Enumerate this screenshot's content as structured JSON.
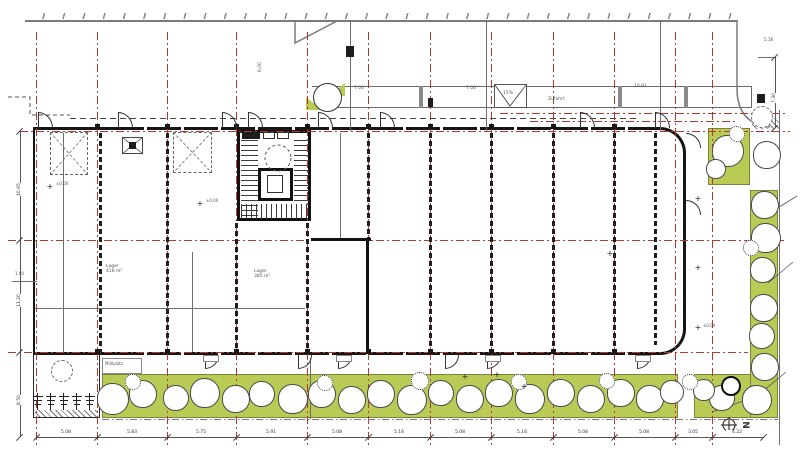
{
  "plan": {
    "north_label": "N",
    "colors": {
      "grid_red": "#b23a30",
      "landscape_green": "#b9ca55",
      "wall_dark": "#161616",
      "line_gray": "#6f6f6f"
    },
    "red_v": [
      36,
      97,
      167,
      236,
      307,
      368,
      430,
      491,
      553,
      614,
      675,
      712
    ],
    "red_h": [
      {
        "y": 131,
        "x1": 20,
        "x2": 790
      },
      {
        "y": 240,
        "x1": 8,
        "x2": 786
      },
      {
        "y": 352,
        "x1": 8,
        "x2": 748
      },
      {
        "y": 113,
        "x1": 500,
        "x2": 786
      },
      {
        "y": 121,
        "x1": 530,
        "x2": 737
      }
    ],
    "partitions": [
      {
        "x": 100,
        "y1": 133,
        "y2": 352
      },
      {
        "x": 167,
        "y1": 133,
        "y2": 352
      },
      {
        "x": 236,
        "y1": 223,
        "y2": 352
      },
      {
        "x": 307,
        "y1": 223,
        "y2": 352
      },
      {
        "x": 368,
        "y1": 133,
        "y2": 238
      },
      {
        "x": 430,
        "y1": 133,
        "y2": 352
      },
      {
        "x": 491,
        "y1": 133,
        "y2": 352
      },
      {
        "x": 553,
        "y1": 133,
        "y2": 352
      },
      {
        "x": 614,
        "y1": 133,
        "y2": 352
      },
      {
        "x": 655,
        "y1": 133,
        "y2": 345
      }
    ],
    "solid_walls": [
      {
        "x": 311,
        "y": 238,
        "w": 60,
        "h": 3
      },
      {
        "x": 366,
        "y": 238,
        "w": 3,
        "h": 114
      }
    ],
    "gray_v": [
      {
        "x": 63,
        "y1": 133,
        "y2": 352
      },
      {
        "x": 192,
        "y1": 252,
        "y2": 352
      },
      {
        "x": 340,
        "y1": 133,
        "y2": 238
      },
      {
        "x": 310,
        "y1": 358,
        "y2": 419
      },
      {
        "x": 350,
        "y1": 21,
        "y2": 131
      },
      {
        "x": 486,
        "y1": 21,
        "y2": 131
      },
      {
        "x": 660,
        "y1": 21,
        "y2": 131
      },
      {
        "x": 779,
        "y1": 110,
        "y2": 445
      }
    ],
    "gray_h": [
      {
        "y": 308,
        "x1": 35,
        "x2": 305
      },
      {
        "y": 281,
        "x1": 12,
        "x2": 37
      },
      {
        "y": 57,
        "x1": 758,
        "x2": 775
      }
    ],
    "dash_h": [
      {
        "y": 118,
        "x1": 70,
        "x2": 640
      }
    ],
    "dashdot_h": [
      {
        "y": 419,
        "x1": 102,
        "x2": 778
      }
    ],
    "pillars": [
      [
        419,
        86,
        4,
        22
      ],
      [
        618,
        86,
        4,
        22
      ],
      [
        684,
        86,
        4,
        22
      ]
    ],
    "dark_blocks": [
      [
        428,
        98,
        5,
        9
      ],
      [
        346,
        46,
        8,
        11
      ],
      [
        757,
        94,
        8,
        9
      ],
      [
        242,
        132,
        18,
        7
      ],
      [
        129,
        142,
        7,
        7
      ]
    ],
    "lockers": [
      [
        263,
        132,
        12,
        7
      ],
      [
        277,
        132,
        12,
        7
      ]
    ],
    "columns_x": [
      97,
      167,
      236,
      307,
      368,
      430,
      491,
      553,
      614
    ],
    "doors": {
      "top": [
        38,
        118,
        222,
        248,
        318,
        380,
        580,
        655
      ],
      "bottom": [
        205,
        298,
        338,
        445,
        487,
        637
      ],
      "right": [
        133,
        200
      ]
    },
    "stoops": [
      203,
      336,
      485,
      635
    ],
    "trees": {
      "bottom": [
        [
          113,
          399,
          16
        ],
        [
          143,
          394,
          14
        ],
        [
          176,
          398,
          13
        ],
        [
          205,
          393,
          15
        ],
        [
          236,
          399,
          14
        ],
        [
          262,
          394,
          13
        ],
        [
          293,
          399,
          15
        ],
        [
          322,
          394,
          14
        ],
        [
          352,
          400,
          14
        ],
        [
          381,
          394,
          14
        ],
        [
          412,
          400,
          15
        ],
        [
          441,
          393,
          13
        ],
        [
          470,
          399,
          14
        ],
        [
          499,
          393,
          14
        ],
        [
          530,
          399,
          15
        ],
        [
          561,
          393,
          14
        ],
        [
          591,
          399,
          14
        ],
        [
          621,
          393,
          14
        ],
        [
          650,
          399,
          14
        ],
        [
          672,
          392,
          12
        ]
      ],
      "right": [
        [
          767,
          155,
          14
        ],
        [
          765,
          205,
          14
        ],
        [
          766,
          238,
          15
        ],
        [
          763,
          270,
          13
        ],
        [
          764,
          308,
          14
        ],
        [
          762,
          336,
          13
        ],
        [
          765,
          367,
          14
        ],
        [
          757,
          400,
          15
        ],
        [
          722,
          398,
          13
        ],
        [
          704,
          390,
          11
        ]
      ],
      "patch": [
        [
          728,
          151,
          16
        ],
        [
          716,
          169,
          10
        ]
      ],
      "dashed": [
        [
          62,
          371,
          11
        ],
        [
          762,
          117,
          11
        ]
      ],
      "accent": [
        731,
        386,
        10
      ]
    },
    "bushes": [
      [
        133,
        382,
        8
      ],
      [
        325,
        383,
        8
      ],
      [
        420,
        381,
        9
      ],
      [
        519,
        382,
        8
      ],
      [
        607,
        381,
        8
      ],
      [
        690,
        382,
        8
      ],
      [
        737,
        134,
        8
      ],
      [
        751,
        248,
        8
      ]
    ],
    "plants_x": [
      38,
      51,
      64,
      77,
      90
    ],
    "crosses": [
      [
        50,
        187
      ],
      [
        200,
        204
      ],
      [
        465,
        377
      ],
      [
        497,
        375
      ],
      [
        698,
        199
      ],
      [
        698,
        268
      ],
      [
        698,
        328
      ],
      [
        610,
        254
      ],
      [
        524,
        387
      ]
    ],
    "leaders": [
      [
        797,
        196,
        771,
        212
      ],
      [
        793,
        262,
        768,
        283
      ],
      [
        786,
        372,
        757,
        396
      ],
      [
        712,
        412,
        752,
        398
      ]
    ],
    "labels": [
      {
        "t": "±0.00",
        "x": 56,
        "y": 182,
        "s": 4
      },
      {
        "t": "±0.00",
        "x": 206,
        "y": 199,
        "s": 4
      },
      {
        "t": "±0.00",
        "x": 703,
        "y": 324,
        "s": 4
      },
      {
        "t": "Lager\n416 m²",
        "x": 106,
        "y": 264,
        "s": 4.5
      },
      {
        "t": "Lager\n385 m²",
        "x": 254,
        "y": 269,
        "s": 4.5
      },
      {
        "t": "Müllplatz",
        "x": 105,
        "y": 362,
        "s": 4
      },
      {
        "t": "Zufahrt",
        "x": 548,
        "y": 97,
        "s": 4.5
      },
      {
        "t": "7.00",
        "x": 354,
        "y": 86,
        "s": 4.5
      },
      {
        "t": "7.00",
        "x": 466,
        "y": 86,
        "s": 4.5
      },
      {
        "t": "10.81",
        "x": 634,
        "y": 84,
        "s": 4.5
      },
      {
        "t": "15%",
        "x": 503,
        "y": 91,
        "s": 4.5
      },
      {
        "t": "6.00",
        "x": 258,
        "y": 72,
        "s": 4.5,
        "rot": -90
      },
      {
        "t": "1.00",
        "x": 15,
        "y": 272,
        "s": 4
      },
      {
        "t": "5.18",
        "x": 764,
        "y": 38,
        "s": 4
      }
    ],
    "dims": {
      "bottom": {
        "y": 437,
        "x1": 36,
        "x2": 763,
        "ticks": [
          36,
          97,
          167,
          236,
          307,
          368,
          430,
          491,
          553,
          614,
          675,
          712,
          763
        ],
        "labels": [
          {
            "x": 66,
            "t": "5.08"
          },
          {
            "x": 132,
            "t": "5.83"
          },
          {
            "x": 201,
            "t": "5.75"
          },
          {
            "x": 271,
            "t": "5.91"
          },
          {
            "x": 337,
            "t": "5.08"
          },
          {
            "x": 399,
            "t": "5.16"
          },
          {
            "x": 460,
            "t": "5.08"
          },
          {
            "x": 522,
            "t": "5.16"
          },
          {
            "x": 583,
            "t": "5.08"
          },
          {
            "x": 644,
            "t": "5.08"
          },
          {
            "x": 693,
            "t": "3.05"
          },
          {
            "x": 737,
            "t": "4.22"
          }
        ]
      },
      "left": {
        "x": 20,
        "y1": 131,
        "y2": 437,
        "ticks": [
          131,
          240,
          352,
          437
        ],
        "labels": [
          {
            "y": 185,
            "t": "10.95"
          },
          {
            "y": 296,
            "t": "11.20"
          },
          {
            "y": 394,
            "t": "8.50"
          }
        ]
      },
      "right": {
        "x": 775,
        "y1": 57,
        "y2": 128,
        "ticks": [
          57,
          128
        ],
        "labels": [
          {
            "y": 92,
            "t": "7.30"
          }
        ]
      }
    }
  }
}
